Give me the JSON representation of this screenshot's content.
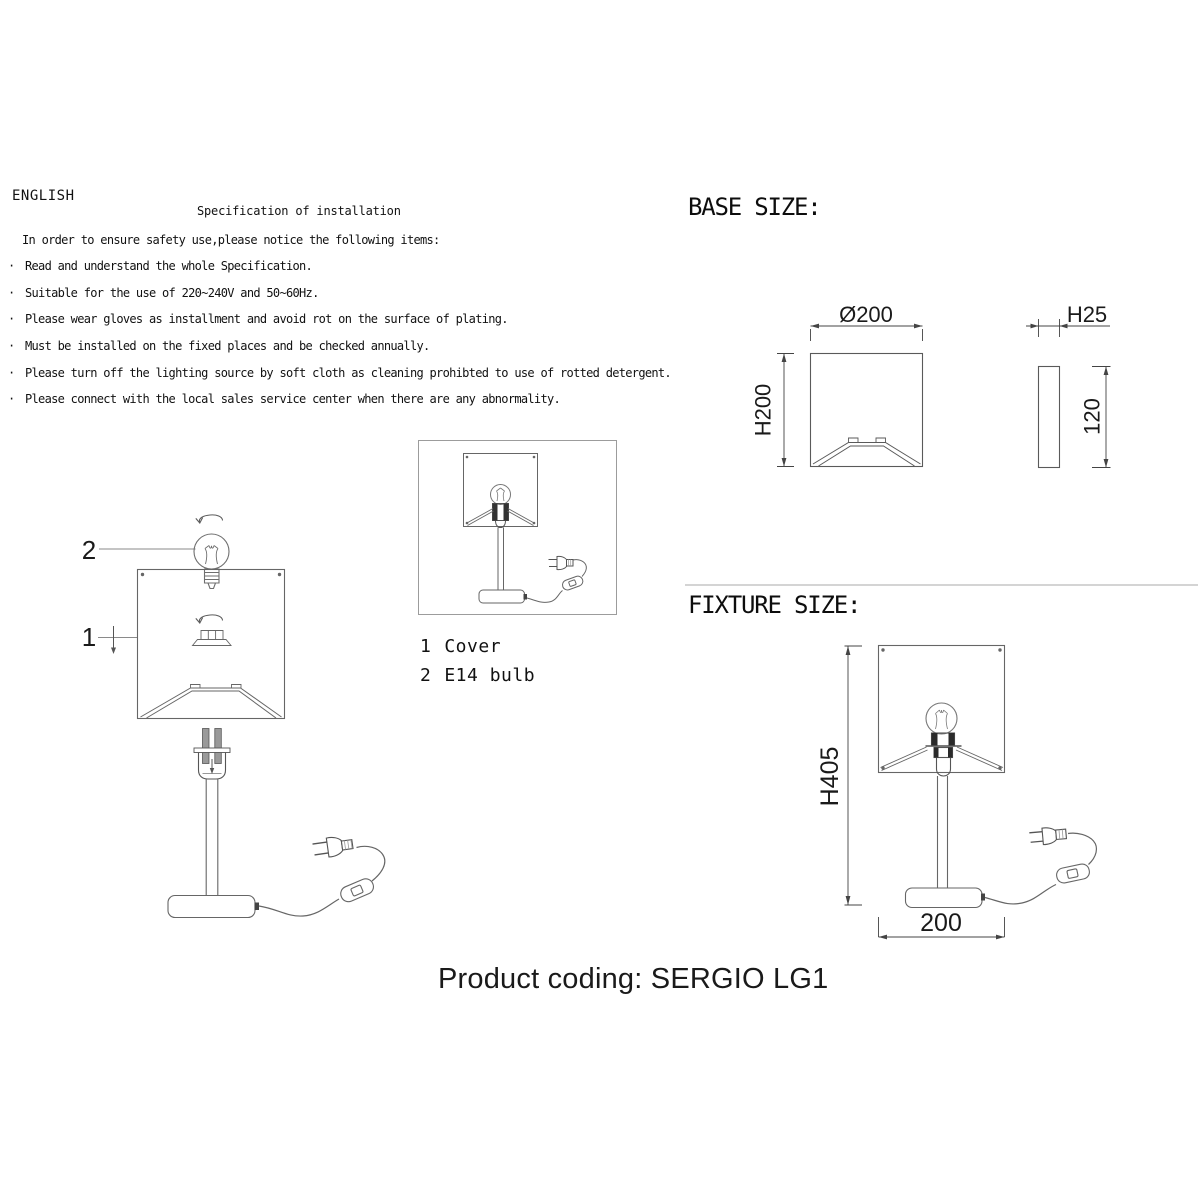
{
  "instructions": {
    "language": "ENGLISH",
    "title": "Specification of installation",
    "intro": "In order to ensure safety use,please notice the following items:",
    "bullet": "·",
    "items": [
      "Read and understand the whole Specification.",
      "Suitable for the use of 220~240V and 50~60Hz.",
      "Please wear gloves as installment and avoid rot on the surface of plating.",
      "Must be installed on the fixed places and be checked annually.",
      "Please turn off the lighting source by soft cloth as cleaning prohibted to use of rotted detergent.",
      "Please connect with the local sales service center when there are any abnormality."
    ]
  },
  "callouts": {
    "cover": "1",
    "bulb": "2"
  },
  "parts": {
    "items": [
      {
        "num": "1",
        "label": "Cover"
      },
      {
        "num": "2",
        "label": "E14 bulb"
      }
    ]
  },
  "base_size": {
    "heading": "BASE SIZE:",
    "dims": {
      "diameter": "Ø200",
      "height": "H200",
      "thickness": "H25",
      "side_height": "120"
    }
  },
  "fixture_size": {
    "heading": "FIXTURE SIZE:",
    "dims": {
      "height": "H405",
      "width": "200"
    }
  },
  "footer": {
    "product_coding": "Product coding: SERGIO LG1"
  },
  "colors": {
    "background": "#ffffff",
    "line": "#666666",
    "dimension_line": "#444444",
    "text": "#111111"
  }
}
